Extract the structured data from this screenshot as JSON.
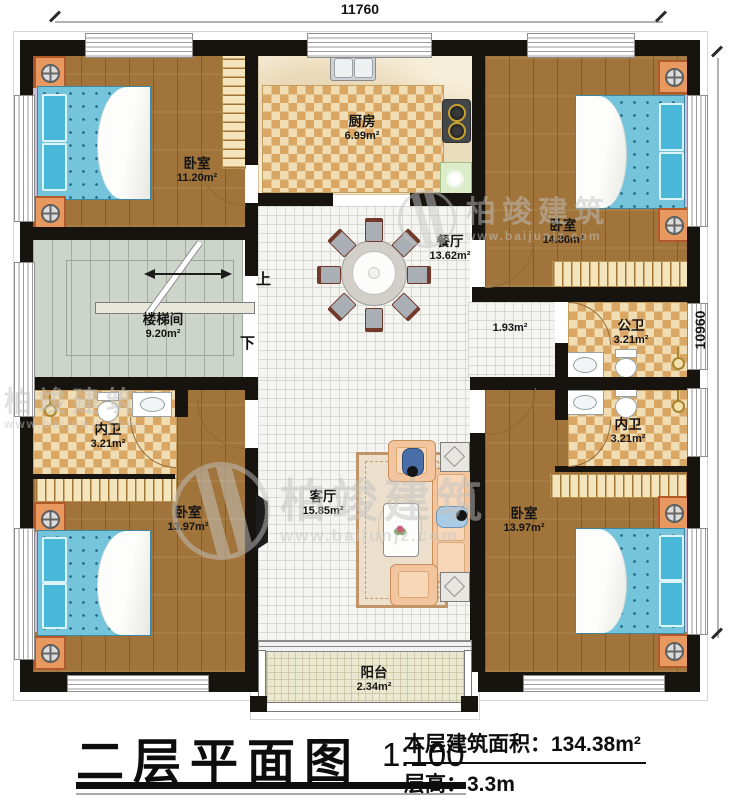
{
  "dimensions": {
    "width_top": "11760",
    "height_right": "10960"
  },
  "stairs": {
    "up": "上",
    "down": "下"
  },
  "rooms": {
    "bedroom_tl": {
      "name": "卧室",
      "area": "11.20m²"
    },
    "kitchen": {
      "name": "厨房",
      "area": "6.99m²"
    },
    "bedroom_tr": {
      "name": "卧室",
      "area": "14.86m²"
    },
    "dining": {
      "name": "餐厅",
      "area": "13.62m²"
    },
    "stairwell": {
      "name": "楼梯间",
      "area": "9.20m²"
    },
    "hallway": {
      "area": "1.93m²"
    },
    "bath_public": {
      "name": "公卫",
      "area": "3.21m²"
    },
    "bath_ensuite_right": {
      "name": "内卫",
      "area": "3.21m²"
    },
    "bath_ensuite_left": {
      "name": "内卫",
      "area": "3.21m²"
    },
    "bedroom_bl": {
      "name": "卧室",
      "area": "13.97m²"
    },
    "living": {
      "name": "客厅",
      "area": "15.85m²"
    },
    "bedroom_br": {
      "name": "卧室",
      "area": "13.97m²"
    },
    "balcony": {
      "name": "阳台",
      "area": "2.34m²"
    }
  },
  "title_block": {
    "title": "二层平面图",
    "scale": "1:100",
    "area_label": "本层建筑面积：",
    "area_value": "134.38m²",
    "height_label": "层高：",
    "height_value": "3.3m"
  },
  "watermark": {
    "brand": "柏竣建筑",
    "site": "www.baijunjz.com"
  },
  "colors": {
    "wall": "#17130e",
    "wood": "#a0743a",
    "bed": "#74c5db",
    "checker": "#d9a763",
    "tile": "#f4f4f1",
    "stair_floor": "#cdd4ca",
    "balcony_floor": "#ebe8d1",
    "label": "#141414"
  }
}
